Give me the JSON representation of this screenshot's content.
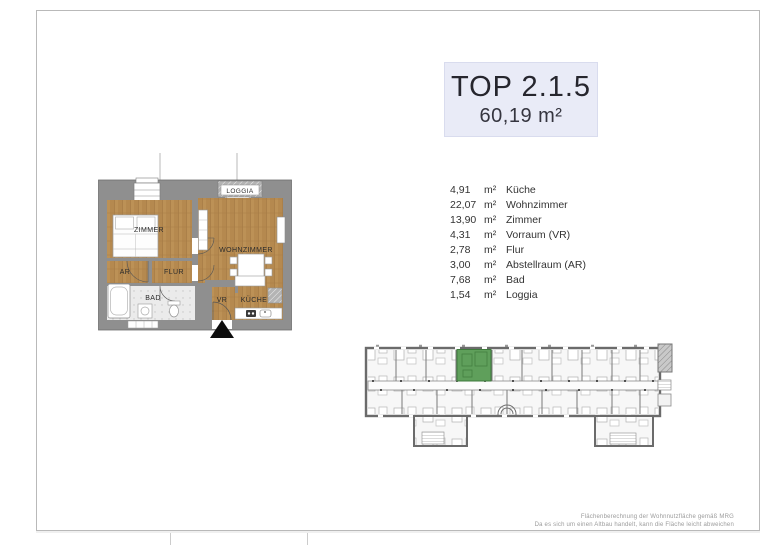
{
  "header": {
    "title": "TOP 2.1.5",
    "total_area": "60,19 m²",
    "box_bg": "#e9ebf7",
    "text_color": "#26262e"
  },
  "floor_plan": {
    "labels": {
      "loggia": "LOGGIA",
      "zimmer": "ZIMMER",
      "wohnzimmer": "WOHNZIMMER",
      "ar": "AR",
      "flur": "FLUR",
      "bad": "BAD",
      "vr": "VR",
      "kueche": "KÜCHE"
    },
    "colors": {
      "wood": "#b5894f",
      "wall": "#8f8f8f",
      "tile": "#ebebeb"
    }
  },
  "room_list": [
    {
      "area": "4,91",
      "unit": "m²",
      "name": "Küche"
    },
    {
      "area": "22,07",
      "unit": "m²",
      "name": "Wohnzimmer"
    },
    {
      "area": "13,90",
      "unit": "m²",
      "name": "Zimmer"
    },
    {
      "area": "4,31",
      "unit": "m²",
      "name": "Vorraum (VR)"
    },
    {
      "area": "2,78",
      "unit": "m²",
      "name": "Flur"
    },
    {
      "area": "3,00",
      "unit": "m²",
      "name": "Abstellraum (AR)"
    },
    {
      "area": "7,68",
      "unit": "m²",
      "name": "Bad"
    },
    {
      "area": "1,54",
      "unit": "m²",
      "name": "Loggia"
    }
  ],
  "site_plan": {
    "highlight_color": "#5f9f5b"
  },
  "footnote": {
    "line1": "Flächenberechnung der Wohnnutzfläche gemäß MRG",
    "line2": "Da es sich um einen Altbau handelt, kann die Fläche leicht abweichen"
  }
}
